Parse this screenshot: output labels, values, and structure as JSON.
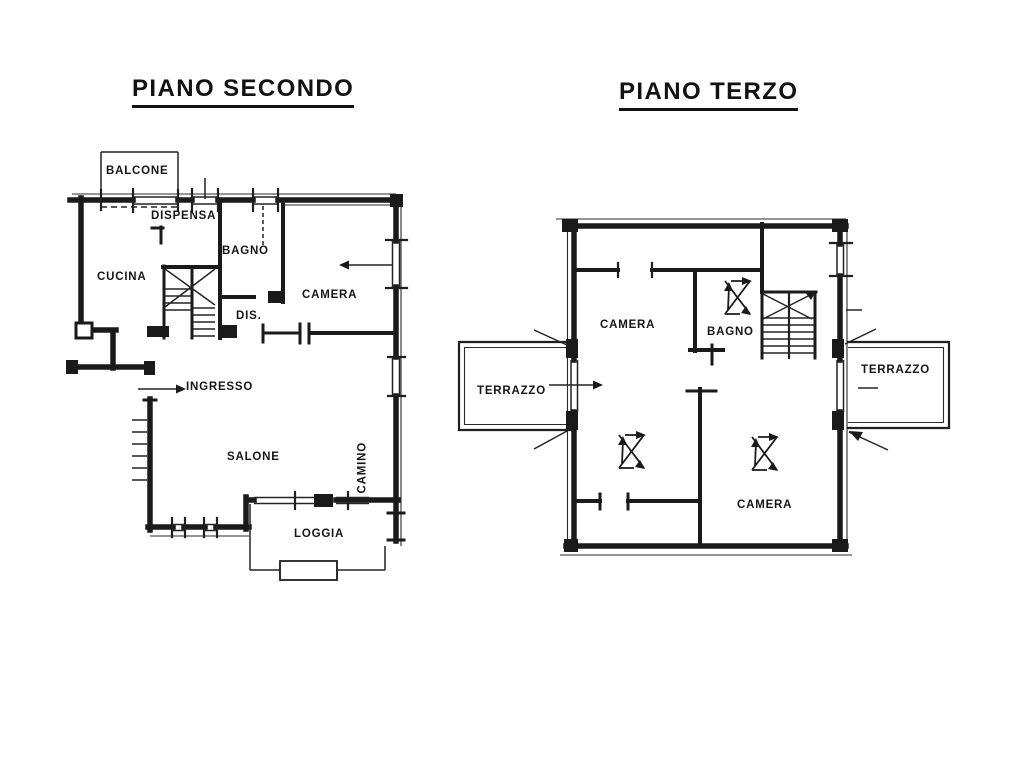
{
  "page": {
    "type": "architectural floor plan drawing",
    "background": "#ffffff",
    "ink": "#1a1a1a"
  },
  "plans": [
    {
      "title": "PIANO SECONDO",
      "rooms": [
        {
          "label": "BALCONE"
        },
        {
          "label": "DISPENSA"
        },
        {
          "label": "BAGNO"
        },
        {
          "label": "CUCINA"
        },
        {
          "label": "CAMERA"
        },
        {
          "label": "DIS."
        },
        {
          "label": "INGRESSO"
        },
        {
          "label": "SALONE"
        },
        {
          "label": "CAMINO"
        },
        {
          "label": "LOGGIA"
        }
      ]
    },
    {
      "title": "PIANO TERZO",
      "rooms": [
        {
          "label": "CAMERA"
        },
        {
          "label": "BAGNO"
        },
        {
          "label": "TERRAZZO"
        },
        {
          "label": "TERRAZZO"
        },
        {
          "label": "CAMERA"
        }
      ]
    }
  ]
}
